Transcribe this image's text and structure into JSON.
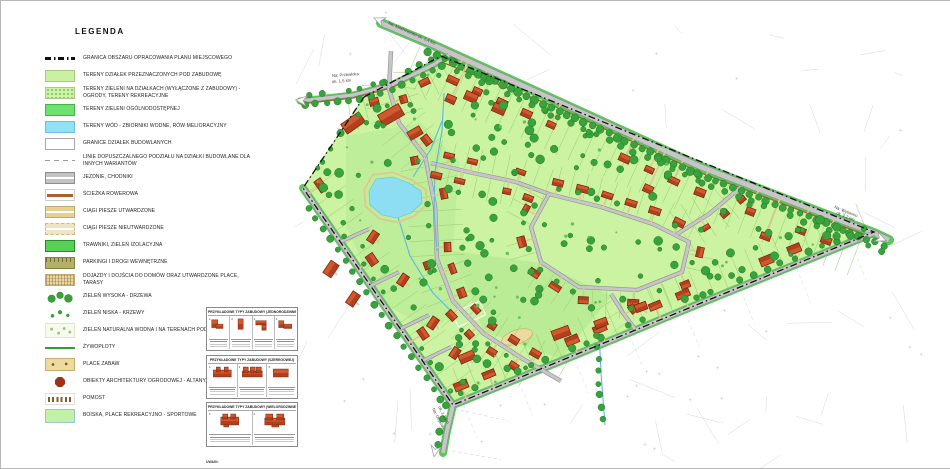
{
  "legend": {
    "title": "LEGENDA",
    "items": [
      {
        "type": "boundary",
        "label": "GRANICA OBSZARU OPRACOWANIA PLANU MIEJSCOWEGO"
      },
      {
        "type": "plots",
        "label": "TERENY DZIAŁEK PRZEZNACZONYCH POD ZABUDOWĘ"
      },
      {
        "type": "plotgreen",
        "label": "TERENY ZIELENI NA DZIAŁKACH (WYŁĄCZONE Z ZABUDOWY) - OGRODY, TERENY REKREACYJNE"
      },
      {
        "type": "publicgreen",
        "label": "TERENY ZIELENI OGÓLNODOSTĘPNEJ"
      },
      {
        "type": "water",
        "label": "TERENY WÓD - ZBIORNIKI WODNE, RÓW MELIORACYJNY"
      },
      {
        "type": "parcel",
        "label": "GRANICE DZIAŁEK BUDOWLANYCH"
      },
      {
        "type": "divlines",
        "label": "LINIE DOPUSZCZALNEGO PODZIAŁU NA DZIAŁKI BUDOWLANE DLA INNYCH WARIANTÓW"
      },
      {
        "type": "road",
        "label": "JEZDNIE, CHODNIKI"
      },
      {
        "type": "bike",
        "label": "ŚCIEŻKA ROWEROWA"
      },
      {
        "type": "pathhard",
        "label": "CIĄGI PIESZE UTWARDZONE"
      },
      {
        "type": "pathsoft",
        "label": "CIĄGI PIESZE NIEUTWARDZONE"
      },
      {
        "type": "lawn",
        "label": "TRAWNIKI, ZIELEŃ IZOLACYJNA"
      },
      {
        "type": "parking",
        "label": "PARKINGI I DROGI WEWNĘTRZNE"
      },
      {
        "type": "driveway",
        "label": "DOJAZDY I DOJŚCIA DO DOMÓW ORAZ UTWARDZONE PLACE, TARASY"
      },
      {
        "type": "trees",
        "label": "ZIELEŃ WYSOKA - DRZEWA"
      },
      {
        "type": "shrubs",
        "label": "ZIELEŃ NISKA - KRZEWY"
      },
      {
        "type": "natgreen",
        "label": "ZIELEŃ NATURALNA WODNA I NA TERENACH PODMOKŁYCH"
      },
      {
        "type": "hedge",
        "label": "ŻYWOPŁOTY"
      },
      {
        "type": "playground",
        "label": "PLACE ZABAW"
      },
      {
        "type": "gazebo",
        "label": "OBIEKTY ARCHITEKTURY OGRODOWEJ - ALTANY, WIATY"
      },
      {
        "type": "pier",
        "label": "POMOST"
      },
      {
        "type": "sports",
        "label": "BOISKA, PLACE REKREACYJNO - SPORTOWE"
      }
    ]
  },
  "map": {
    "labels": {
      "top": {
        "text": "Na: Machowinko ok. 1,4 km"
      },
      "left": {
        "line1": "Na: Przewłoka",
        "line2": "ok. 1,5 km"
      },
      "right": {
        "line1": "Na: Wytowno",
        "line2": "ok. 1,2 km"
      },
      "bottom": {
        "line1": "Na: Objazda",
        "line2": "ok. 1,1 km"
      }
    },
    "colors": {
      "site_green": "#cbf3a2",
      "public_green": "#bfee9a",
      "water_blue": "#8ddef3",
      "road_gray": "#c6c6c6",
      "verge_green": "#5ac85a",
      "tree_green": "#39a23c",
      "building_red": "#b23f1d",
      "path_tan": "#dcc795",
      "bike_brown": "#a8612f",
      "boundary": "#111111"
    }
  },
  "insets": {
    "boxes": [
      {
        "title": "PRZYKŁADOWE TYPY ZABUDOWY (JEDNORODZINNEJ)",
        "cells": [
          "1",
          "2",
          "3",
          "4"
        ]
      },
      {
        "title": "PRZYKŁADOWE TYPY ZABUDOWY (SZEREGOWEJ)",
        "cells": [
          "1",
          "2",
          "3"
        ]
      },
      {
        "title": "PRZYKŁADOWE TYPY ZABUDOWY (WIELORODZINNEJ)",
        "cells": [
          "1",
          "2"
        ]
      }
    ],
    "notes_title": "UWAGI:"
  }
}
